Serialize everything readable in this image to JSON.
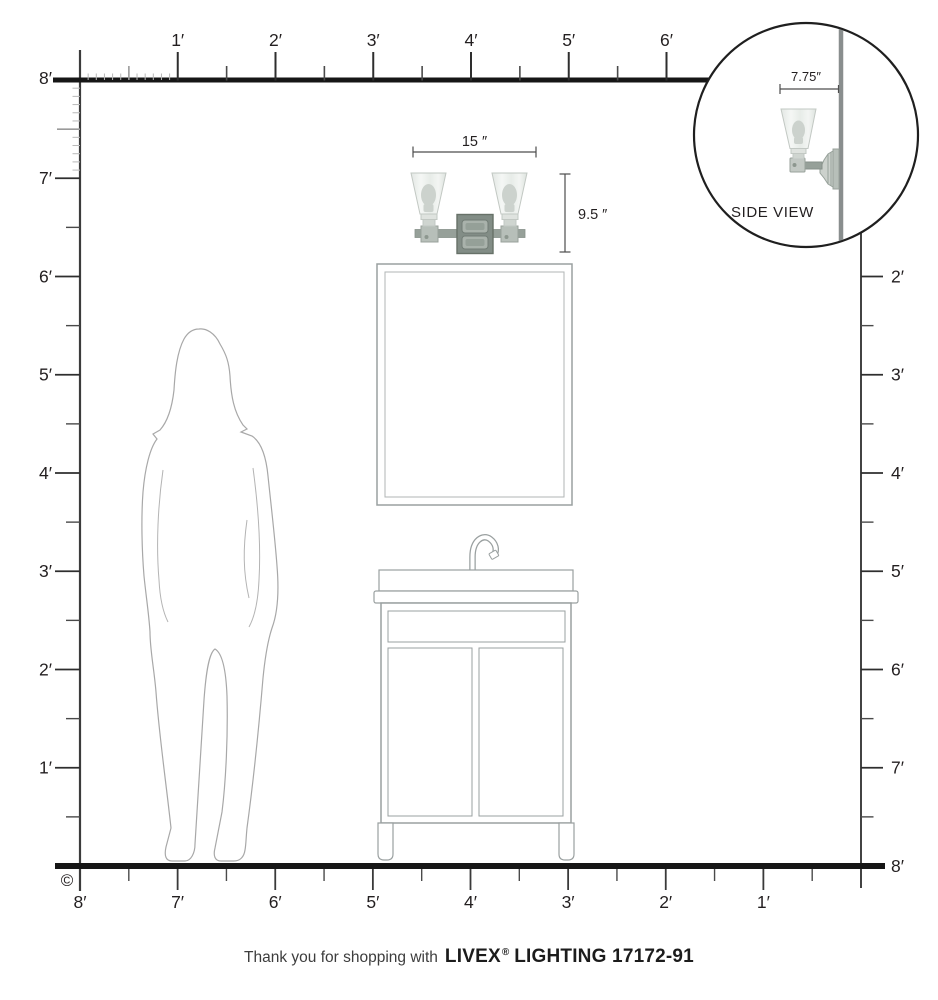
{
  "rulers": {
    "top": [
      "1′",
      "2′",
      "3′",
      "4′",
      "5′",
      "6′"
    ],
    "left": [
      "8′",
      "7′",
      "6′",
      "5′",
      "4′",
      "3′",
      "2′",
      "1′"
    ],
    "right": [
      "2′",
      "3′",
      "4′",
      "5′",
      "6′",
      "7′",
      "8′"
    ],
    "bottom": [
      "8′",
      "7′",
      "6′",
      "5′",
      "4′",
      "3′",
      "2′",
      "1′"
    ]
  },
  "dimensions": {
    "fixture_width_label": "15 ″",
    "fixture_height_label": "9.5 ″",
    "side_extension_label": "7.75″"
  },
  "inset": {
    "label": "SIDE VIEW"
  },
  "copyright_symbol": "©",
  "footer": {
    "message": "Thank you for shopping with",
    "brand": "LIVEX",
    "reg": "®",
    "rest": "LIGHTING 17172-91"
  },
  "colors": {
    "ruler_dark": "#2e2e2e",
    "thick_line": "#161616",
    "outline_gray": "#9aa0a0",
    "shade_fill": "#e9ece9",
    "bulb_fill": "#ccd2cd",
    "backplate": "#828d86",
    "wall_gray": "#898e8e"
  }
}
